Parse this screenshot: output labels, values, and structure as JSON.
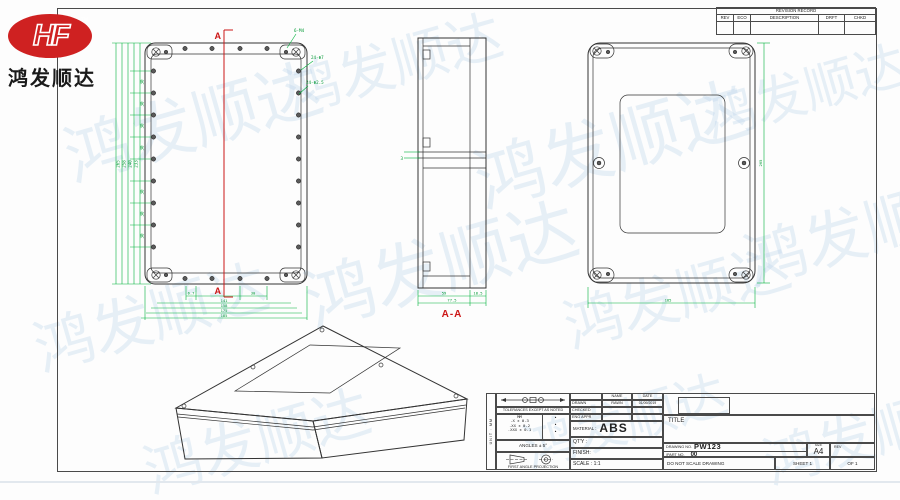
{
  "logo": {
    "brand": "HF",
    "trademark": "TM",
    "company": "鸿发顺达"
  },
  "watermark": {
    "text": "鸿发顺达"
  },
  "revision_table": {
    "title": "REVISION RECORD",
    "columns": [
      "REV",
      "ECO",
      "DESCRIPTION",
      "DRFT",
      "CHKD"
    ]
  },
  "views": {
    "front": {
      "section_top": "A",
      "section_bottom": "A",
      "callouts": [
        "6-M4",
        "24-Φ7",
        "24-Φ2.5"
      ],
      "left_dims": {
        "spacing": "30",
        "totals": [
          "233",
          "240",
          "258",
          "265"
        ]
      },
      "bottom_dims": {
        "segments": [
          "6.7",
          "30"
        ],
        "totals": [
          "141",
          "158",
          "175",
          "185"
        ]
      }
    },
    "section": {
      "label": "A-A",
      "gap": "3",
      "segments": [
        "59",
        "18.5"
      ],
      "total": "77.5"
    },
    "back": {
      "width": "185",
      "height": "265"
    }
  },
  "title_block": {
    "side_strip": "UNIT : MM",
    "tolerances": {
      "header": "TOLERANCES EXCEPT AS NOTED",
      "unit": "MM",
      "rows": [
        ".X ± 0.3",
        ".XX ± 0.2",
        ".XXX ± 0.1"
      ],
      "bullet": "•"
    },
    "angles": "ANGLES ± 5°",
    "projection_label": "FIRST ANGLE PROJECTION",
    "approvals": {
      "name_header": "NAME",
      "date_header": "DATE",
      "rows": [
        {
          "label": "DRAWN",
          "name": "RAWN",
          "date": "01/09/2019"
        },
        {
          "label": "CHECKED",
          "name": "",
          "date": ""
        },
        {
          "label": "ENG APPR",
          "name": "",
          "date": ""
        }
      ]
    },
    "material_label": "MATERIAL :",
    "material": "ABS",
    "qty_label": "QT'Y :",
    "finish_label": "FINISH:",
    "scale_label": "SCALE : 1:1",
    "title_label": "TITLE",
    "drawing_no_label": "DRAWING NO.",
    "drawing_no": "PW123",
    "part_no_label": "/PART  NO.",
    "part_no": "00",
    "size_label": "SIZE",
    "size": "A4",
    "rev_label": "REV",
    "do_not_scale": "DO NOT SCALE DRAWING",
    "sheet": "SHEET 1",
    "of": "OF 1"
  }
}
